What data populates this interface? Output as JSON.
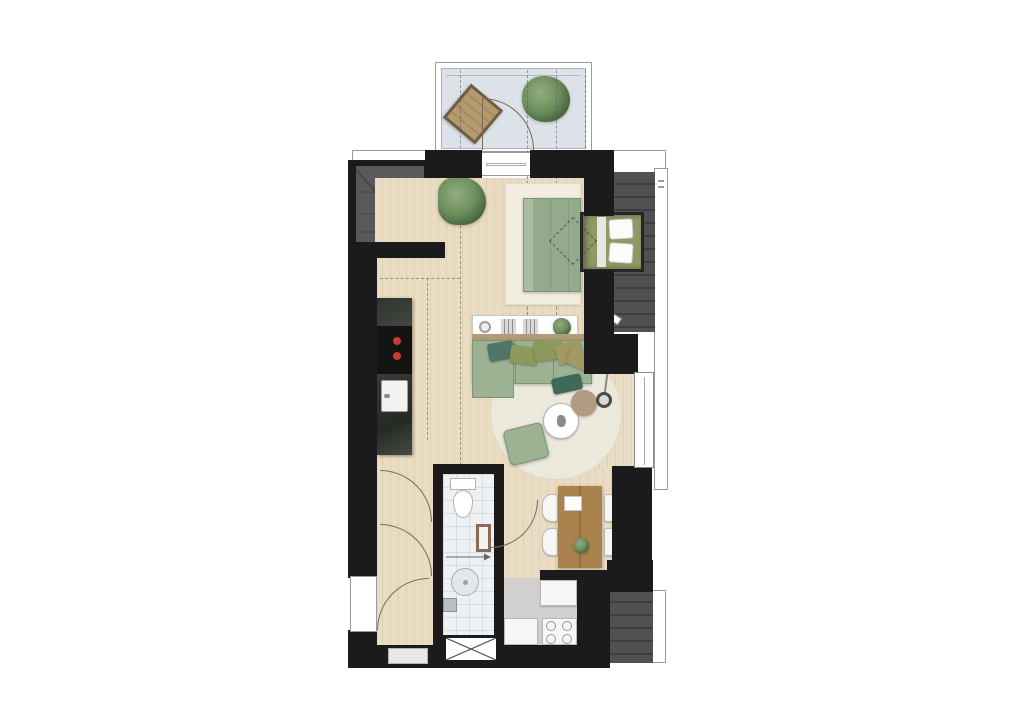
{
  "canvas": {
    "width": 1024,
    "height": 724,
    "background": "#ffffff"
  },
  "plan": {
    "type": "architectural-floor-plan-top-view",
    "rooms": [
      {
        "id": "balcony",
        "floor": "light-concrete"
      },
      {
        "id": "living-area",
        "floor": "wood-plank"
      },
      {
        "id": "sleeping-area",
        "floor": "wood-plank",
        "rug": "cream"
      },
      {
        "id": "kitchen",
        "floor": "wood-plank"
      },
      {
        "id": "hallway",
        "floor": "wood-plank"
      },
      {
        "id": "bathroom",
        "floor": "white-tile-grid"
      },
      {
        "id": "dining-area",
        "floor": "wood-plank"
      },
      {
        "id": "utility-area",
        "floor": "gray-screed"
      },
      {
        "id": "stairwell",
        "floor": "dark-gray"
      }
    ],
    "furniture": [
      {
        "id": "lounge-chair",
        "room": "balcony",
        "color_key": "chair_tan"
      },
      {
        "id": "potted-plant-balcony",
        "room": "balcony"
      },
      {
        "id": "potted-plant-living",
        "room": "living-area"
      },
      {
        "id": "double-bed",
        "room": "sleeping-area",
        "color_key": "bed"
      },
      {
        "id": "dormer-bed-niche",
        "room": "sleeping-area",
        "pillows": 2
      },
      {
        "id": "roof-window-marker",
        "room": "sleeping-area",
        "style": "dashed-diamond"
      },
      {
        "id": "kitchen-counter",
        "appliances": [
          "cooktop",
          "sink"
        ],
        "burner_knobs": 2
      },
      {
        "id": "sideboard",
        "items": [
          "bowl",
          "books",
          "books",
          "plant"
        ]
      },
      {
        "id": "corner-sofa",
        "cushions": 5,
        "throw": 1
      },
      {
        "id": "round-rug"
      },
      {
        "id": "coffee-table"
      },
      {
        "id": "side-pouf"
      },
      {
        "id": "ottoman"
      },
      {
        "id": "floor-lamp"
      },
      {
        "id": "dining-table",
        "chairs": 4,
        "items": [
          "tray",
          "plant"
        ]
      },
      {
        "id": "toilet"
      },
      {
        "id": "mirror-cabinet"
      },
      {
        "id": "shower-drain"
      },
      {
        "id": "floor-drain"
      },
      {
        "id": "utility-cabinet",
        "count": 2
      },
      {
        "id": "washer-dryer"
      },
      {
        "id": "duct-shaft",
        "style": "crossed-box"
      }
    ],
    "openings": [
      "balcony-door",
      "entry-door",
      "hall-door-upper",
      "bathroom-door",
      "utility-door",
      "window-right"
    ],
    "annotations": [
      "height-contour-dashed-lines",
      "roof-slope-slat-hatching",
      "stair-diagonal",
      "shower-slope-arrow",
      "gutter-tick-marks"
    ]
  },
  "palette": {
    "bg": "#ffffff",
    "wall": "#1b1b1b",
    "wood": "#e9dcc3",
    "wood_line": "#e0d0b2",
    "balcony_floor": "#dde2e9",
    "roof": "#515153",
    "roof_line": "#3e3e40",
    "stair": "#59595b",
    "stair_line": "#47474a",
    "outline": "#9a9a9a",
    "rug_bed": "#f1ede1",
    "rug_round": "#ebe8dc",
    "sofa": "#9cb292",
    "sofa_edge": "#7c9377",
    "bed": "#94aa8c",
    "bed_foot": "#a9bca0",
    "niche_fill": "#8d9a66",
    "pillow_white": "#fbfbf9",
    "cushion_teal": "#4f7568",
    "cushion_olive": "#8d9a5e",
    "cushion_khaki": "#a19a62",
    "throw_green": "#3f6a59",
    "counter": "#2f342e",
    "counter_vein": "#454c42",
    "cooktop": "#141414",
    "burner": "#c43b31",
    "tile": "#eef1f3",
    "tile_line": "#d7dce1",
    "gray_floor": "#d2d0cf",
    "table": "#a9824e",
    "table_dark": "#93703f",
    "chair": "#f6f6f5",
    "chair_tan": "#b59a6f",
    "chair_tan_dark": "#6f5d40",
    "plant_dark": "#3f5c38",
    "plant_mid": "#6d8f5e",
    "plant_light": "#92ad7d",
    "pouf": "#b39a82",
    "arc": "#7c6a55",
    "dash": "#555555",
    "white": "#ffffff"
  }
}
